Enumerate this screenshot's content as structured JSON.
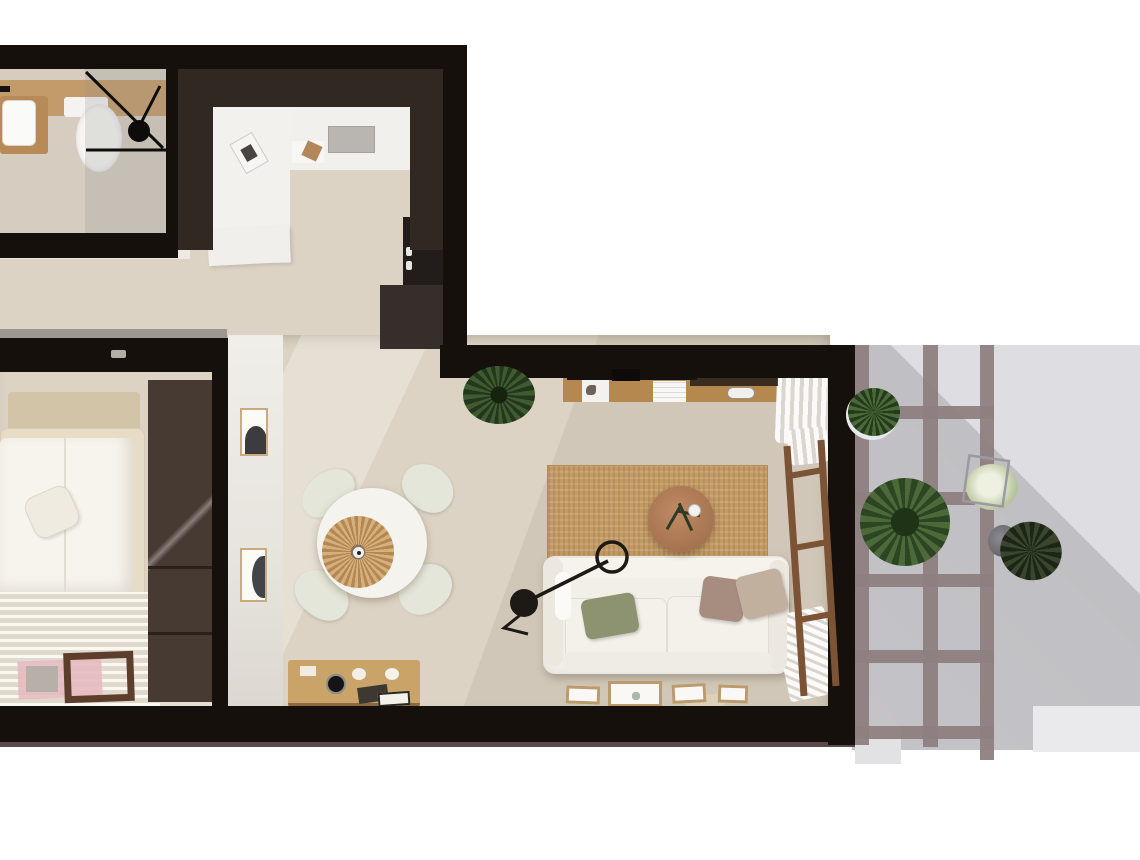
{
  "scene": {
    "kind": "top-down 3d apartment floor plan render",
    "rooms": [
      "bathroom",
      "entry-kitchen",
      "bedroom",
      "dining-area",
      "living-room",
      "balcony"
    ],
    "furnishings": {
      "bathroom": [
        "wood-vanity-sink",
        "toilet",
        "glass-shower",
        "shower-head"
      ],
      "entry_kitchen": [
        "white-counter",
        "doormat",
        "book",
        "cabinet",
        "tall-dark-unit",
        "base-unit"
      ],
      "bedroom": [
        "headboard",
        "double-bed",
        "duvet",
        "pillow",
        "striped-rug",
        "pink-rug",
        "wood-bench",
        "dark-wardrobe"
      ],
      "dining": [
        "round-white-table",
        "four-chairs",
        "rattan-centerpiece",
        "wood-console",
        "record-player",
        "two-wall-frames"
      ],
      "living": [
        "potted-plant",
        "wood-desk",
        "desk-chair",
        "jute-rug",
        "round-coffee-table",
        "white-sofa",
        "throw-pillows",
        "arc-floor-lamp",
        "leaning-frames",
        "curtains",
        "wood-ladder",
        "radiator"
      ],
      "balcony": [
        "trellis-screen",
        "plant-saucer",
        "large-plant",
        "white-flower-plant",
        "wire-stand",
        "potted-agave",
        "step"
      ]
    }
  },
  "palette": {
    "wall_black": "#16100d",
    "wall_dark_brown": "#312822",
    "wardrobe_brown": "#473a32",
    "floor_beige": "#dcd3c4",
    "bath_floor": "#d6cdc0",
    "bath_wood": "#c39b6a",
    "concrete_gray": "#9d9791",
    "maroon_base": "#4e343a",
    "balcony_gray": "#d3d2d6",
    "trellis_mauve": "#8e7f80",
    "hall_wall_white": "#edebe6",
    "table_white": "#f5f3ee",
    "chair_sage": "#e3e6d8",
    "rattan_tan": "#c89a5e",
    "coffee_wood": "#b07b58",
    "rug_jute": "#c49a63",
    "rug_bedroom": "#ebe4d8",
    "pink_accent": "#e6bac1",
    "sofa_white": "#f2efe8",
    "pillow_green": "#8d9270",
    "pillow_mauve": "#a78d80",
    "pillow_beige": "#c2b09f",
    "bed_frame": "#e7dcc5",
    "duvet_white": "#f7f4ed",
    "headboard_tan": "#d2c5a7",
    "desk_wood": "#b4884f",
    "console_wood": "#c9a368",
    "ladder_wood": "#7c5334",
    "lamp_black": "#1d1915",
    "glass_frame_black": "#0e0c0b"
  }
}
